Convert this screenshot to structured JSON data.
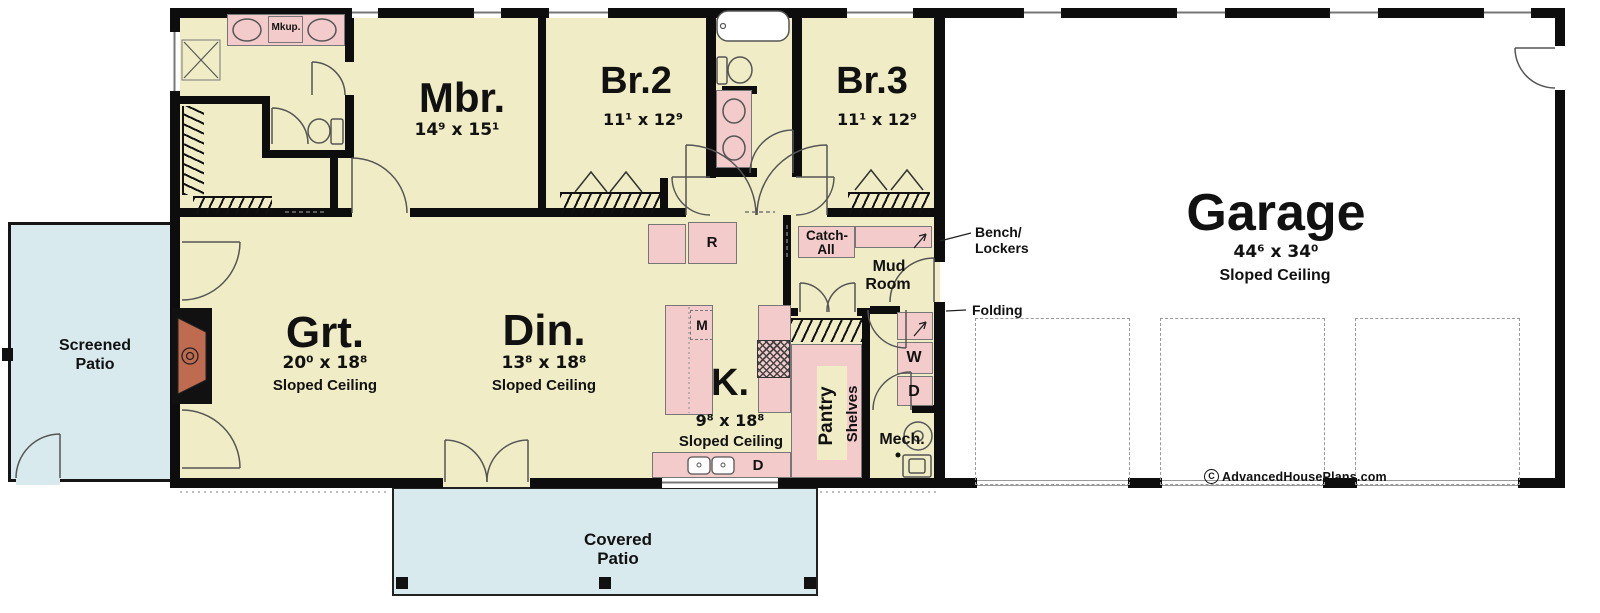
{
  "colors": {
    "floor": "#f0edc6",
    "patio": "#d9eaef",
    "cabinet": "#f3cbcb",
    "fireplace": "#bf6b50",
    "wall": "#0d0d0d",
    "garage_floor": "#ffffff"
  },
  "rooms": {
    "mbr": {
      "name": "Mbr.",
      "dims": "14⁹ x 15¹"
    },
    "br2": {
      "name": "Br.2",
      "dims": "11¹ x 12⁹"
    },
    "br3": {
      "name": "Br.3",
      "dims": "11¹ x 12⁹"
    },
    "grt": {
      "name": "Grt.",
      "dims": "20⁰ x 18⁸",
      "note": "Sloped Ceiling"
    },
    "din": {
      "name": "Din.",
      "dims": "13⁸ x 18⁸",
      "note": "Sloped Ceiling"
    },
    "kitchen": {
      "name": "K.",
      "dims": "9⁸ x 18⁸",
      "note": "Sloped Ceiling"
    },
    "garage": {
      "name": "Garage",
      "dims": "44⁶ x 34⁰",
      "note": "Sloped Ceiling"
    },
    "mud": {
      "line1": "Mud",
      "line2": "Room"
    },
    "screened_patio": {
      "line1": "Screened",
      "line2": "Patio"
    },
    "covered_patio": {
      "line1": "Covered",
      "line2": "Patio"
    }
  },
  "labels": {
    "makeup": "Mkup.",
    "catch_all_line1": "Catch-",
    "catch_all_line2": "All",
    "bench_line1": "Bench/",
    "bench_line2": "Lockers",
    "folding": "Folding",
    "pantry": "Pantry",
    "shelves": "Shelves",
    "mech": "Mech.",
    "washer": "W",
    "dryer": "D",
    "microwave": "M",
    "refrigerator": "R",
    "dishwasher": "D"
  },
  "credit": {
    "mark": "C",
    "text": "AdvancedHousePlans.com"
  }
}
